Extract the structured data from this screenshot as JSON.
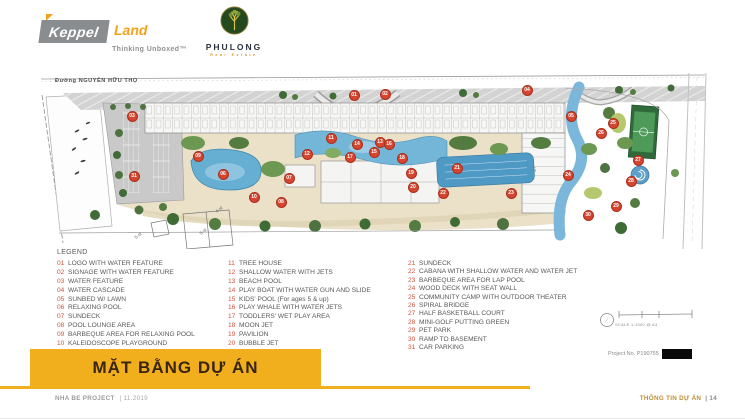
{
  "header": {
    "keppel": {
      "name": "Keppel",
      "land": "Land",
      "tagline": "Thinking Unboxed™"
    },
    "phulong": {
      "name": "PHULONG",
      "subtitle": "Real Estate"
    }
  },
  "plan": {
    "street_label": "Đường NGUYỄN HỮU THỌ",
    "tower_label": "T5",
    "future_blocks": [
      "5-st",
      "5-st",
      "4-st"
    ],
    "scale_label": "SCALE 1:1000 @ A3",
    "project_no": "Project No. P190755",
    "markers": [
      {
        "n": "01",
        "x": 321,
        "y": 22
      },
      {
        "n": "02",
        "x": 352,
        "y": 21
      },
      {
        "n": "03",
        "x": 99,
        "y": 43
      },
      {
        "n": "04",
        "x": 494,
        "y": 17
      },
      {
        "n": "05",
        "x": 538,
        "y": 43
      },
      {
        "n": "06",
        "x": 190,
        "y": 101
      },
      {
        "n": "07",
        "x": 256,
        "y": 105
      },
      {
        "n": "08",
        "x": 248,
        "y": 129
      },
      {
        "n": "09",
        "x": 165,
        "y": 83
      },
      {
        "n": "10",
        "x": 221,
        "y": 124
      },
      {
        "n": "11",
        "x": 298,
        "y": 65
      },
      {
        "n": "12",
        "x": 274,
        "y": 81
      },
      {
        "n": "13",
        "x": 347,
        "y": 69
      },
      {
        "n": "14",
        "x": 324,
        "y": 71
      },
      {
        "n": "15",
        "x": 341,
        "y": 79
      },
      {
        "n": "16",
        "x": 356,
        "y": 71
      },
      {
        "n": "17",
        "x": 317,
        "y": 84
      },
      {
        "n": "18",
        "x": 369,
        "y": 85
      },
      {
        "n": "19",
        "x": 378,
        "y": 100
      },
      {
        "n": "20",
        "x": 380,
        "y": 114
      },
      {
        "n": "21",
        "x": 424,
        "y": 95
      },
      {
        "n": "22",
        "x": 410,
        "y": 120
      },
      {
        "n": "23",
        "x": 478,
        "y": 120
      },
      {
        "n": "24",
        "x": 535,
        "y": 102
      },
      {
        "n": "25",
        "x": 580,
        "y": 50
      },
      {
        "n": "26",
        "x": 568,
        "y": 60
      },
      {
        "n": "27",
        "x": 605,
        "y": 87
      },
      {
        "n": "28",
        "x": 598,
        "y": 108
      },
      {
        "n": "29",
        "x": 583,
        "y": 133
      },
      {
        "n": "30",
        "x": 555,
        "y": 142
      },
      {
        "n": "31",
        "x": 101,
        "y": 103
      }
    ]
  },
  "legend": {
    "title": "LEGEND",
    "columns": [
      [
        {
          "num": "01",
          "label": "LOGO WITH WATER FEATURE"
        },
        {
          "num": "02",
          "label": "SIGNAGE WITH WATER FEATURE"
        },
        {
          "num": "03",
          "label": "WATER FEATURE"
        },
        {
          "num": "04",
          "label": "WATER CASCADE"
        },
        {
          "num": "05",
          "label": "SUNBED W/ LAWN"
        },
        {
          "num": "06",
          "label": "RELAXING POOL"
        },
        {
          "num": "07",
          "label": "SUNDECK"
        },
        {
          "num": "08",
          "label": "POOL LOUNGE AREA"
        },
        {
          "num": "09",
          "label": "BARBEQUE AREA FOR RELAXING POOL"
        },
        {
          "num": "10",
          "label": "KALEIDOSCOPE PLAYGROUND"
        }
      ],
      [
        {
          "num": "11",
          "label": "TREE HOUSE"
        },
        {
          "num": "12",
          "label": "SHALLOW WATER WITH JETS"
        },
        {
          "num": "13",
          "label": "BEACH POOL"
        },
        {
          "num": "14",
          "label": "PLAY BOAT WITH WATER GUN AND SLIDE"
        },
        {
          "num": "15",
          "label": "KIDS' POOL (For ages 5 & up)"
        },
        {
          "num": "16",
          "label": "PLAY WHALE WITH WATER JETS"
        },
        {
          "num": "17",
          "label": "TODDLERS' WET PLAY AREA"
        },
        {
          "num": "18",
          "label": "MOON JET"
        },
        {
          "num": "19",
          "label": "PAVILION"
        },
        {
          "num": "20",
          "label": "BUBBLE JET"
        }
      ],
      [
        {
          "num": "21",
          "label": "SUNDECK"
        },
        {
          "num": "22",
          "label": "CABANA WITH SHALLOW WATER AND WATER JET"
        },
        {
          "num": "23",
          "label": "BARBEQUE AREA FOR LAP POOL"
        },
        {
          "num": "24",
          "label": "WOOD DECK WITH SEAT WALL"
        },
        {
          "num": "25",
          "label": "COMMUNITY CAMP WITH OUTDOOR THEATER"
        },
        {
          "num": "26",
          "label": "SPIRAL BRIDGE"
        },
        {
          "num": "27",
          "label": "HALF BASKETBALL COURT"
        },
        {
          "num": "28",
          "label": "MINI-GOLF PUTTING GREEN"
        },
        {
          "num": "29",
          "label": "PET PARK"
        },
        {
          "num": "30",
          "label": "RAMP TO BASEMENT"
        },
        {
          "num": "31",
          "label": "CAR PARKING"
        }
      ]
    ]
  },
  "title_bar": "MẶT BẰNG DỰ ÁN",
  "footer": {
    "project": "NHA BE PROJECT",
    "date": "| 11.2019",
    "section": "THÔNG TIN DỰ ÁN",
    "page": "| 14"
  },
  "colors": {
    "accent_yellow": "#F2AF1D",
    "marker_red": "#D5452F",
    "gold_text": "#BE8E35",
    "keppel_gray": "#8A8D8F",
    "keppel_orange": "#F5A11C",
    "water_blue": "#66AED2",
    "tree_green": "#4E7340"
  }
}
